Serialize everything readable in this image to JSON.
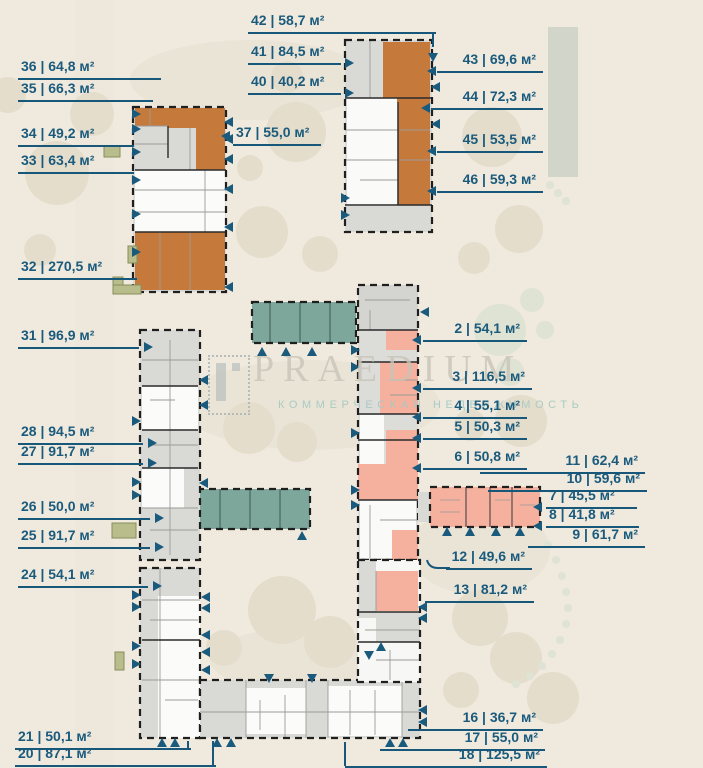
{
  "watermark": {
    "brand": "PRAEDIUM",
    "tagline": "КОММЕРЧЕСКАЯ НЕДВИЖИМОСТЬ"
  },
  "colors": {
    "label": "#1a5b7d",
    "marker": "#1a5b7d",
    "unit_orange": "#c57a3c",
    "unit_salmon": "#f5b09e",
    "unit_teal": "#7ea79c",
    "background": "#f0e9dd"
  },
  "area_unit": "м²",
  "separator": "|",
  "units": [
    {
      "id": "2",
      "area": "54,1",
      "label": "2 | 54,1 м²"
    },
    {
      "id": "3",
      "area": "116,5",
      "label": "3 | 116,5 м²"
    },
    {
      "id": "4",
      "area": "55,1",
      "label": "4 | 55,1 м²"
    },
    {
      "id": "5",
      "area": "50,3",
      "label": "5 | 50,3 м²"
    },
    {
      "id": "6",
      "area": "50,8",
      "label": "6 | 50,8 м²"
    },
    {
      "id": "7",
      "area": "45,5",
      "label": "7 | 45,5 м²"
    },
    {
      "id": "8",
      "area": "41,8",
      "label": "8 | 41,8 м²"
    },
    {
      "id": "9",
      "area": "61,7",
      "label": "9 | 61,7 м²"
    },
    {
      "id": "10",
      "area": "59,6",
      "label": "10 | 59,6 м²"
    },
    {
      "id": "11",
      "area": "62,4",
      "label": "11 | 62,4 м²"
    },
    {
      "id": "12",
      "area": "49,6",
      "label": "12 | 49,6 м²"
    },
    {
      "id": "13",
      "area": "81,2",
      "label": "13 | 81,2 м²"
    },
    {
      "id": "16",
      "area": "36,7",
      "label": "16 | 36,7 м²"
    },
    {
      "id": "17",
      "area": "55,0",
      "label": "17 | 55,0 м²"
    },
    {
      "id": "18",
      "area": "125,5",
      "label": "18 | 125,5 м²"
    },
    {
      "id": "20",
      "area": "87,1",
      "label": "20 | 87,1 м²"
    },
    {
      "id": "21",
      "area": "50,1",
      "label": "21 | 50,1 м²"
    },
    {
      "id": "24",
      "area": "54,1",
      "label": "24 | 54,1 м²"
    },
    {
      "id": "25",
      "area": "91,7",
      "label": "25 | 91,7 м²"
    },
    {
      "id": "26",
      "area": "50,0",
      "label": "26 | 50,0 м²"
    },
    {
      "id": "27",
      "area": "91,7",
      "label": "27 | 91,7 м²"
    },
    {
      "id": "28",
      "area": "94,5",
      "label": "28 | 94,5 м²"
    },
    {
      "id": "31",
      "area": "96,9",
      "label": "31 | 96,9 м²"
    },
    {
      "id": "32",
      "area": "270,5",
      "label": "32 | 270,5 м²"
    },
    {
      "id": "33",
      "area": "63,4",
      "label": "33 | 63,4 м²"
    },
    {
      "id": "34",
      "area": "49,2",
      "label": "34 | 49,2 м²"
    },
    {
      "id": "35",
      "area": "66,3",
      "label": "35 | 66,3 м²"
    },
    {
      "id": "36",
      "area": "64,8",
      "label": "36 | 64,8 м²"
    },
    {
      "id": "37",
      "area": "55,0",
      "label": "37 | 55,0 м²"
    },
    {
      "id": "40",
      "area": "40,2",
      "label": "40 | 40,2 м²"
    },
    {
      "id": "41",
      "area": "84,5",
      "label": "41 | 84,5 м²"
    },
    {
      "id": "42",
      "area": "58,7",
      "label": "42 | 58,7 м²"
    },
    {
      "id": "43",
      "area": "69,6",
      "label": "43 | 69,6 м²"
    },
    {
      "id": "44",
      "area": "72,3",
      "label": "44 | 72,3 м²"
    },
    {
      "id": "45",
      "area": "53,5",
      "label": "45 | 53,5 м²"
    },
    {
      "id": "46",
      "area": "59,3",
      "label": "46 | 59,3 м²"
    }
  ]
}
